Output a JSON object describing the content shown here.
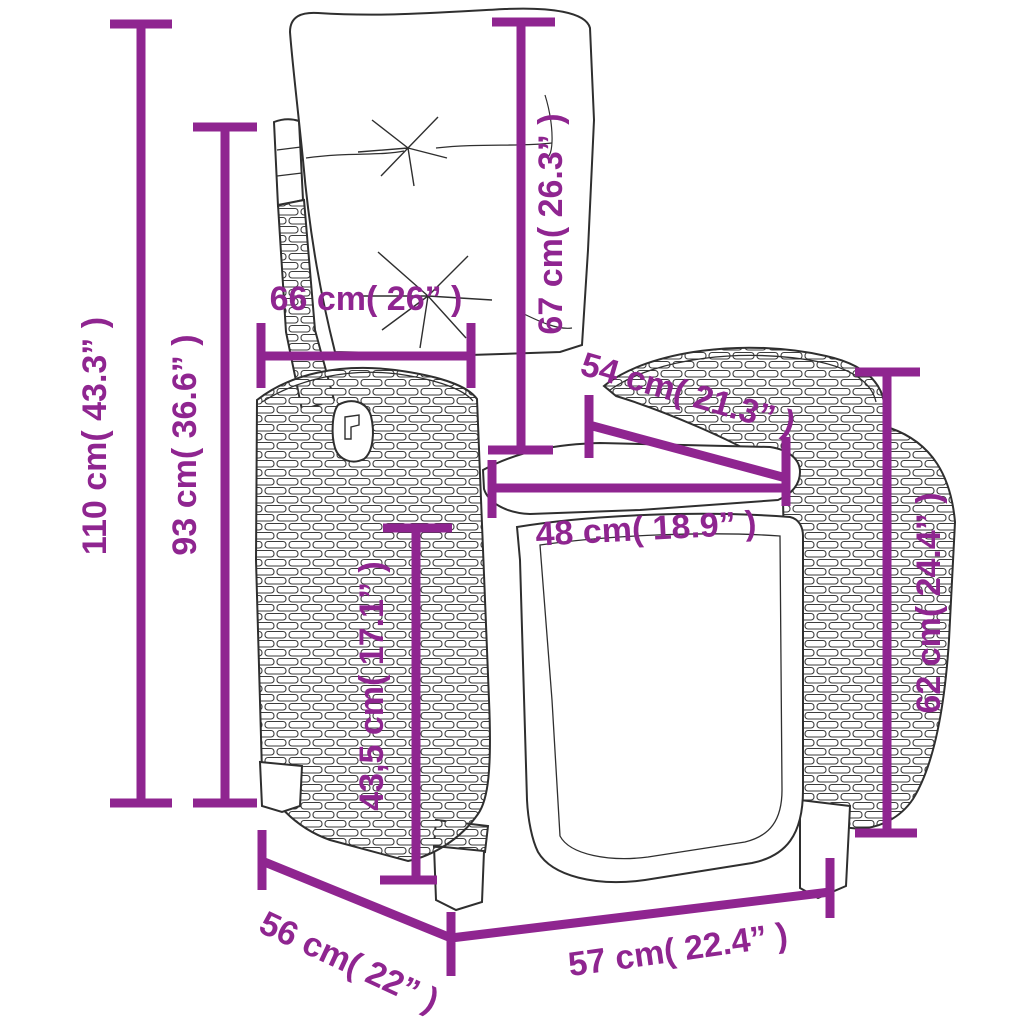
{
  "figure": {
    "type": "product-dimension-diagram",
    "subject": "reclining rattan garden chair with cushions",
    "accent_color": "#8F2590",
    "line_art_color": "#2F2F2F",
    "background_color": "#FFFFFF"
  },
  "dimensions": [
    {
      "id": "total-height",
      "value_cm": "110",
      "value_in": "43.3",
      "label": "110 cm( 43.3” )"
    },
    {
      "id": "back-height",
      "value_cm": "93",
      "value_in": "36.6",
      "label": "93 cm( 36.6” )"
    },
    {
      "id": "back-width",
      "value_cm": "66",
      "value_in": "26",
      "label": "66 cm( 26” )"
    },
    {
      "id": "cushion-height",
      "value_cm": "67",
      "value_in": "26.3",
      "label": "67 cm( 26.3” )"
    },
    {
      "id": "seat-depth",
      "value_cm": "54",
      "value_in": "21.3",
      "label": "54 cm( 21.3” )"
    },
    {
      "id": "seat-width",
      "value_cm": "48",
      "value_in": "18.9",
      "label": "48 cm( 18.9” )"
    },
    {
      "id": "arm-height",
      "value_cm": "62",
      "value_in": "24.4",
      "label": "62 cm( 24.4” )"
    },
    {
      "id": "seat-height",
      "value_cm": "43,5",
      "value_in": "17.1",
      "label": "43,5 cm( 17.1” )"
    },
    {
      "id": "base-depth",
      "value_cm": "56",
      "value_in": "22",
      "label": "56 cm( 22” )"
    },
    {
      "id": "base-width",
      "value_cm": "57",
      "value_in": "22.4",
      "label": "57 cm( 22.4” )"
    }
  ]
}
